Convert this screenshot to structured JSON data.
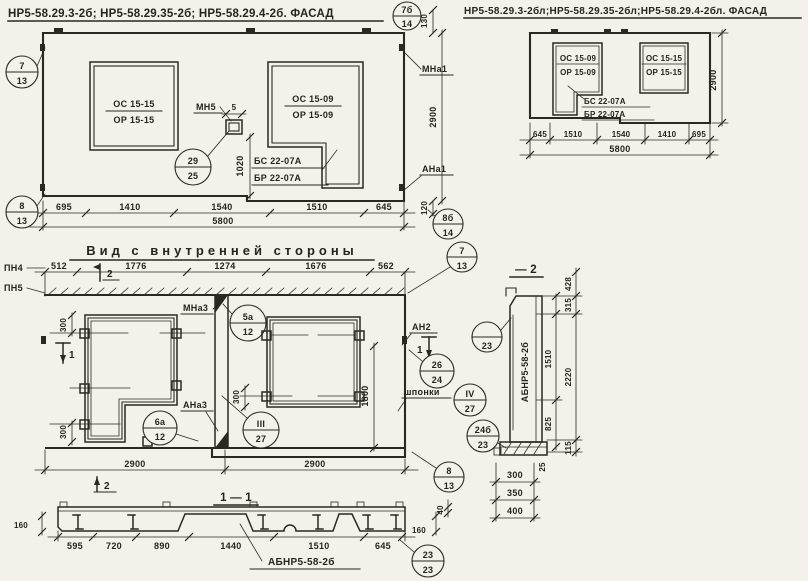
{
  "page": {
    "bg": "#f3f1ea",
    "ink": "#2b2822"
  },
  "titles": {
    "facade_left": "НР5-58.29.3-2б; НР5-58.29.35-2б; НР5-58.29.4-2б. ФАСАД",
    "facade_right": "НР5-58.29.3-2бл;НР5-58.29.35-2бл;НР5-58.29.4-2бл. ФАСАД",
    "inner_view": "Вид с внутренней стороны",
    "section_11": "1 — 1",
    "section_2": "— 2"
  },
  "facade_left": {
    "window_left": {
      "top": "ОС 15-15",
      "bottom": "ОР 15-15"
    },
    "window_right": {
      "top": "ОС 15-09",
      "bottom": "ОР 15-09"
    },
    "sill": {
      "top": "БС 22-07А",
      "bottom": "БР 22-07А"
    },
    "labels": {
      "mn5": "МН5",
      "mna1": "МНа1",
      "ana1": "АНа1"
    },
    "dims": {
      "d5": "5",
      "d1020": "1020",
      "d130": "130",
      "d120": "120",
      "height": "2900",
      "chain": [
        "695",
        "1410",
        "1540",
        "1510",
        "645"
      ],
      "total": "5800"
    },
    "callouts": {
      "top_left": {
        "num": "7",
        "den": "13"
      },
      "bottom_left": {
        "num": "8",
        "den": "13"
      },
      "top_right": {
        "num": "7б",
        "den": "14"
      },
      "bottom_right": {
        "num": "8б",
        "den": "14"
      },
      "anchor": {
        "num": "29",
        "den": "25"
      }
    }
  },
  "facade_right": {
    "window_left": {
      "top": "ОС 15-09",
      "bottom": "ОР 15-09"
    },
    "window_right": {
      "top": "ОС 15-15",
      "bottom": "ОР 15-15"
    },
    "sill": {
      "top": "БС 22-07А",
      "bottom": "БР 22-07А"
    },
    "dims": {
      "height": "2900",
      "chain": [
        "645",
        "1510",
        "1540",
        "1410",
        "695"
      ],
      "total": "5800"
    }
  },
  "inner_view": {
    "labels": {
      "pn4": "ПН4",
      "pn5": "ПН5",
      "mna3": "МНа3",
      "ana3": "АНа3",
      "an2": "АН2",
      "shponki": "шпонки"
    },
    "markers": {
      "top": "2",
      "bottom": "2",
      "left": "1",
      "right": "1"
    },
    "dims": {
      "chain_top": [
        "512",
        "1776",
        "1274",
        "1676",
        "562"
      ],
      "d300a": "300",
      "d300b": "300",
      "d300c": "300",
      "d1800": "1800",
      "chain_bottom": [
        "2900",
        "2900"
      ]
    },
    "callouts": {
      "top_right": {
        "num": "7",
        "den": "13"
      },
      "bottom_right": {
        "num": "8",
        "den": "13"
      },
      "c5a": {
        "num": "5а",
        "den": "12"
      },
      "c6a": {
        "num": "6а",
        "den": "12"
      },
      "c3": {
        "num": "III",
        "den": "27"
      },
      "c4": {
        "num": "IV",
        "den": "27"
      },
      "c26": {
        "num": "26",
        "den": "24"
      }
    }
  },
  "section_2": {
    "panel_mark": "АБНР5-58-2б",
    "dims": {
      "d428": "428",
      "d315": "315",
      "d1510": "1510",
      "d2220": "2220",
      "d825": "825",
      "d115": "115",
      "d25": "25",
      "d300": "300",
      "d350": "350",
      "d400": "400"
    },
    "callouts": {
      "c23": {
        "num": "",
        "den": "23"
      },
      "c24b": {
        "num": "24б",
        "den": "23"
      }
    }
  },
  "section_11": {
    "panel_mark": "АБНР5-58-2б",
    "dims": {
      "chain": [
        "595",
        "720",
        "890",
        "1440",
        "1510",
        "645"
      ],
      "d160l": "160",
      "d160r": "160",
      "d40": "40"
    },
    "callouts": {
      "c23": {
        "num": "23",
        "den": "23"
      }
    }
  }
}
